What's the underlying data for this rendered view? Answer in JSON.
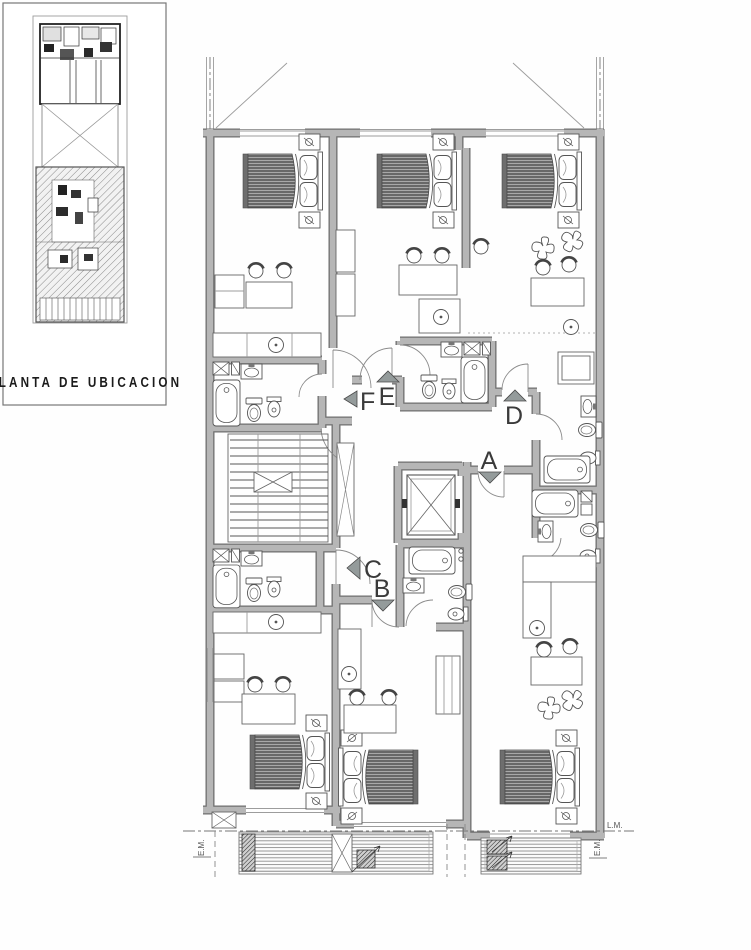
{
  "colors": {
    "wall_fill": "#b6b6b6",
    "wall_edge": "#6f6f6f",
    "line_dark": "#555555",
    "line_light": "#9c9c9c",
    "arrow_fill": "#949b9b",
    "text": "#3a3a3a"
  },
  "location_inset": {
    "title": "PLANTA DE UBICACION"
  },
  "floor_plan": {
    "unit_entries": [
      {
        "label": "A",
        "arrow_direction": "down"
      },
      {
        "label": "B",
        "arrow_direction": "down"
      },
      {
        "label": "C",
        "arrow_direction": "left"
      },
      {
        "label": "D",
        "arrow_direction": "up"
      },
      {
        "label": "E",
        "arrow_direction": "up"
      },
      {
        "label": "F",
        "arrow_direction": "left"
      }
    ],
    "boundary_labels": {
      "left_em": "E.M.",
      "right_em": "E.M.",
      "lm": "L.M."
    }
  }
}
